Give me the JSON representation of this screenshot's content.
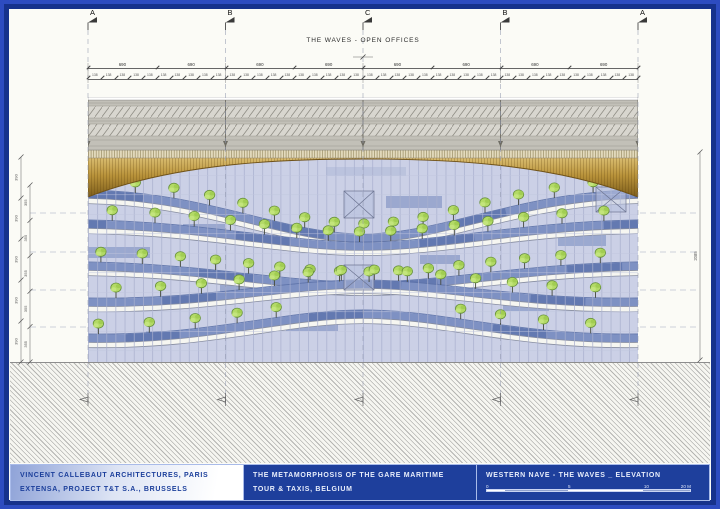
{
  "drawing": {
    "title": "THE WAVES - OPEN OFFICES"
  },
  "grid": {
    "letters": [
      "A",
      "B",
      "C",
      "B",
      "A"
    ]
  },
  "dimensions": {
    "top_spans": [
      "690",
      "690",
      "690",
      "690",
      "690",
      "690",
      "690",
      "690"
    ],
    "sub_span": {
      "value": "138",
      "count": 40
    },
    "left_levels": [
      "390",
      "390",
      "390",
      "390",
      "390"
    ],
    "left_inner": [
      "355",
      "355",
      "355",
      "355",
      "355"
    ],
    "right_total": "2085"
  },
  "titleblock": {
    "architect_line1": "VINCENT CALLEBAUT ARCHITECTURES, PARIS",
    "architect_line2": "EXTENSA, PROJECT T&T S.A., BRUSSELS",
    "project_line1": "THE METAMORPHOSIS OF THE GARE MARITIME",
    "project_line2": "TOUR & TAXIS, BELGIUM",
    "sheet_title": "WESTERN NAVE - THE WAVES _ ELEVATION",
    "scale_labels": [
      "0",
      "5",
      "10",
      "20 M"
    ]
  },
  "colors": {
    "frame_outer": "#2d4cc0",
    "frame_inner": "#16328c",
    "titleblock_bg": "#1e3f9c",
    "glass": "#cbd0e6",
    "terrace_band": "#7e91c3",
    "tree_green": "#b3da66",
    "wood_top": "#d9bc6f",
    "wood_bottom": "#7e5e1c"
  }
}
